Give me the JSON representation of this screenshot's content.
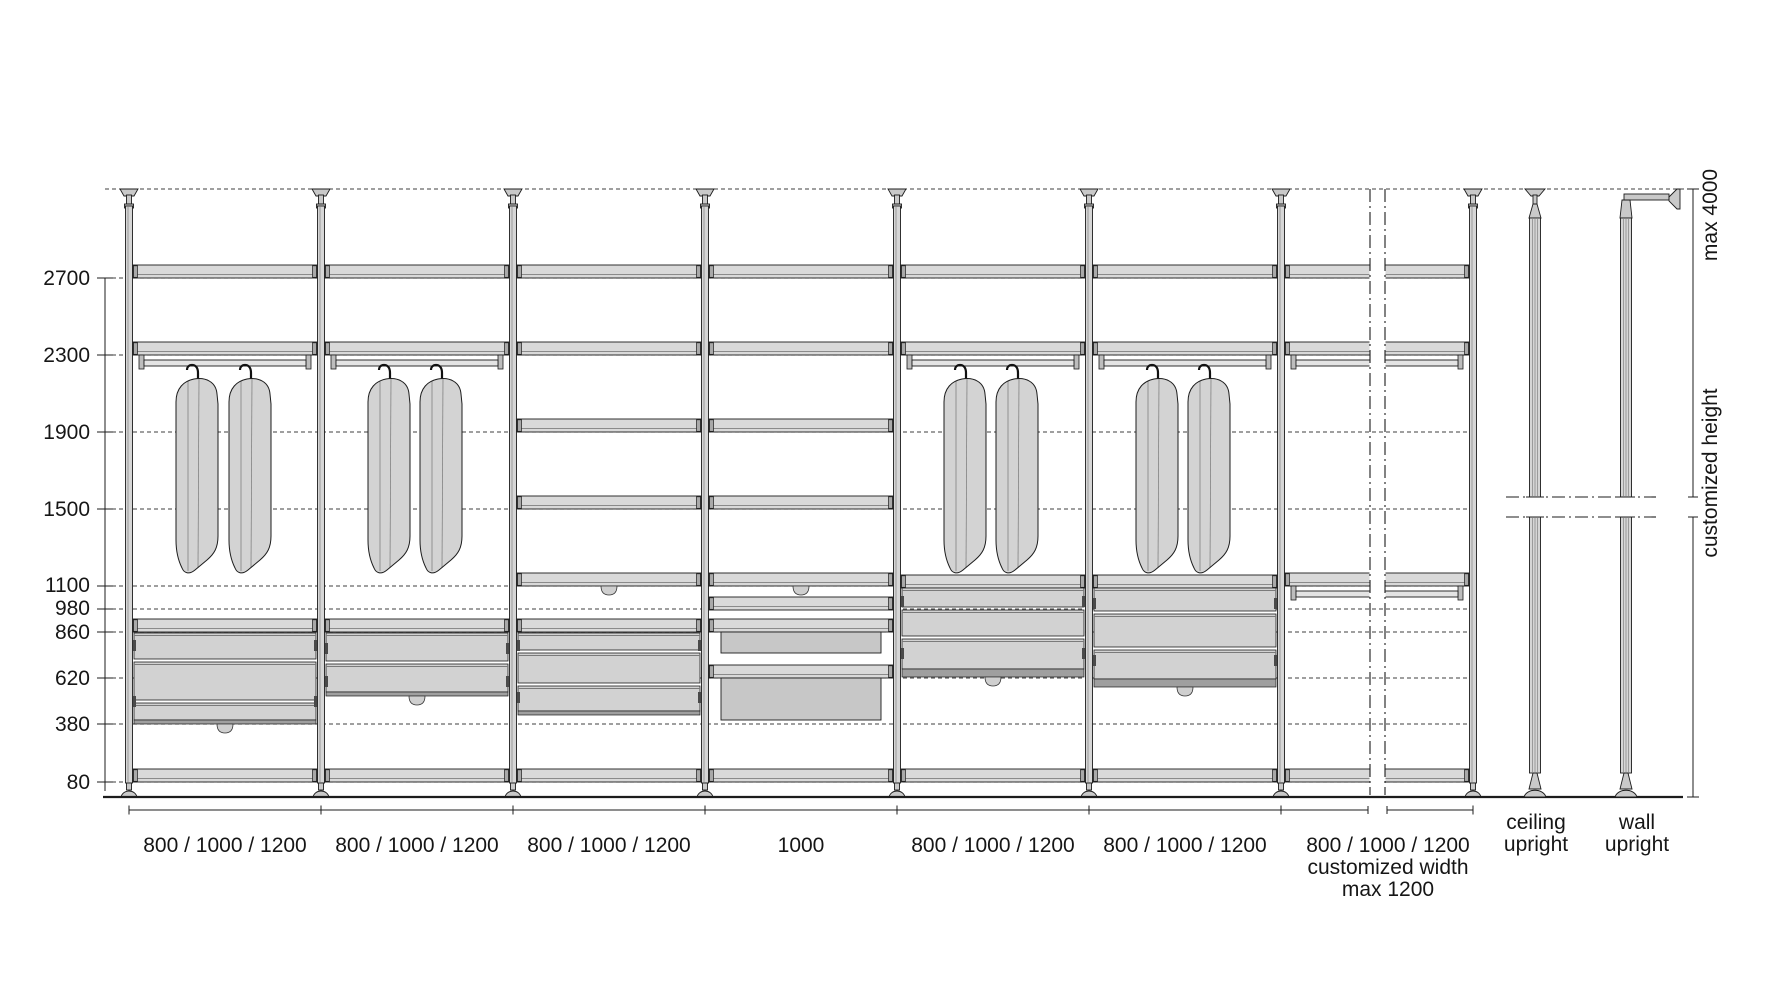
{
  "diagram": {
    "height_labels": [
      "2700",
      "2300",
      "1900",
      "1500",
      "1100",
      "980",
      "860",
      "620",
      "380",
      "80"
    ],
    "bay_width_labels": [
      "800 / 1000 / 1200",
      "800 / 1000 / 1200",
      "800 / 1000 / 1200",
      "1000",
      "800 / 1000 / 1200",
      "800 / 1000 / 1200",
      "800 / 1000 / 1200"
    ],
    "bay7_note_1": "customized width",
    "bay7_note_2": "max 1200",
    "right_label_top": "max 4000",
    "right_label_bottom": "customized height",
    "legend_ceiling": [
      "ceiling",
      "upright"
    ],
    "legend_wall": [
      "wall",
      "upright"
    ],
    "colors": {
      "line": "#1c1c1c",
      "fill_light": "#d9d9d9",
      "fill_mid": "#c7c7c7",
      "background": "#ffffff"
    }
  }
}
